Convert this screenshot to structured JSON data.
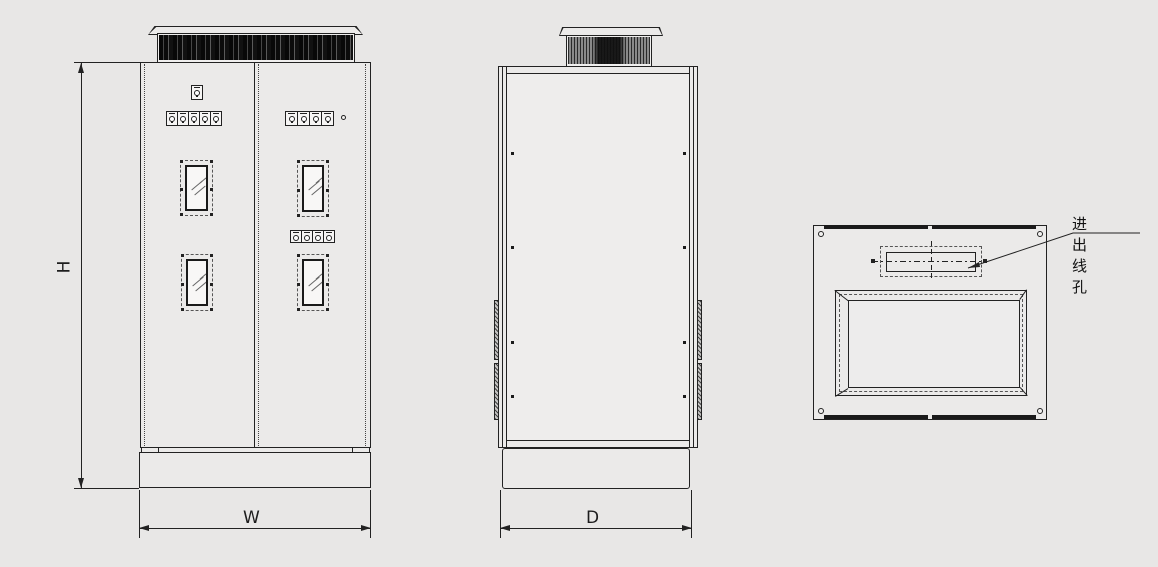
{
  "drawing": {
    "type": "electrical-cabinet-three-view-engineering-drawing",
    "labels": {
      "height": "H",
      "width": "W",
      "depth": "D"
    },
    "annotation": {
      "cable_hole": "进出线孔"
    },
    "views": {
      "front": "front-view",
      "side": "side-view",
      "top": "top-view"
    }
  },
  "colors": {
    "background": "#e8e7e6",
    "line": "#222222",
    "panel": "#ebeae9",
    "glass": "#f8f7f6",
    "fan_grille": "#0a0a0a"
  }
}
